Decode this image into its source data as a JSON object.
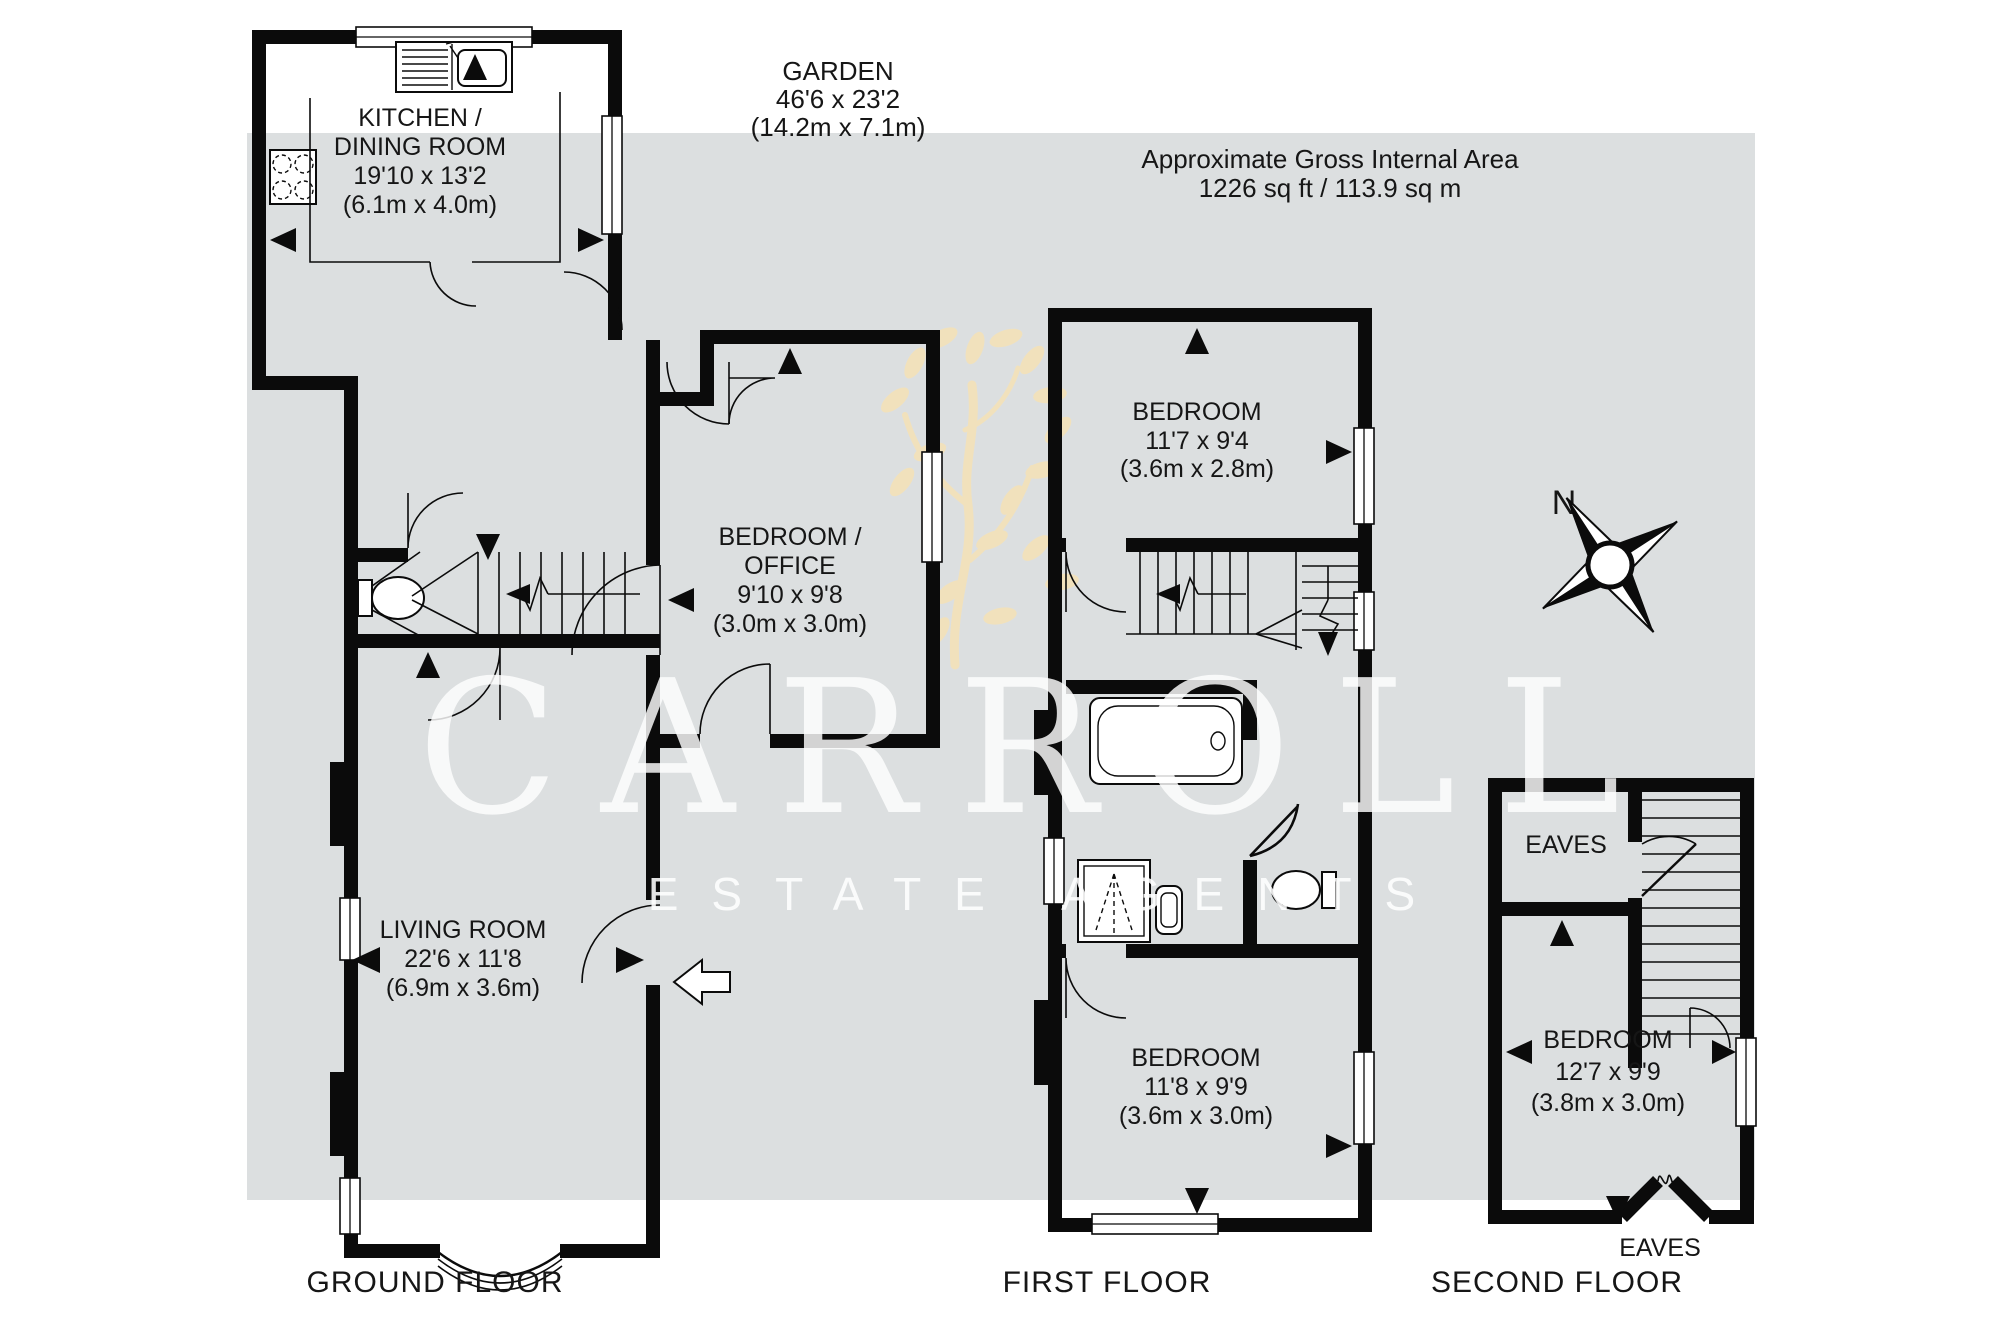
{
  "canvas": {
    "background": "#ffffff",
    "panel_color": "#dcdfe0",
    "ink_color": "#0b0b0b",
    "leaf_color": "#f3e2bb",
    "watermark_color": "#ffffff"
  },
  "garden": {
    "name": "GARDEN",
    "size_imperial": "46'6 x 23'2",
    "size_metric": "(14.2m x 7.1m)"
  },
  "area_note": {
    "line1": "Approximate Gross Internal Area",
    "line2": "1226 sq ft / 113.9 sq m"
  },
  "compass": {
    "north": "N"
  },
  "watermark": {
    "brand": "CARROLL",
    "tagline": "ESTATE AGENTS"
  },
  "ground_floor": {
    "label": "GROUND FLOOR",
    "kitchen": {
      "line1": "KITCHEN /",
      "line2": "DINING ROOM",
      "size_imperial": "19'10 x 13'2",
      "size_metric": "(6.1m x 4.0m)"
    },
    "bedroom_office": {
      "line1": "BEDROOM /",
      "line2": "OFFICE",
      "size_imperial": "9'10 x 9'8",
      "size_metric": "(3.0m x 3.0m)"
    },
    "living_room": {
      "line1": "LIVING ROOM",
      "size_imperial": "22'6 x 11'8",
      "size_metric": "(6.9m x 3.6m)"
    }
  },
  "first_floor": {
    "label": "FIRST FLOOR",
    "bedroom_top": {
      "line1": "BEDROOM",
      "size_imperial": "11'7 x 9'4",
      "size_metric": "(3.6m x 2.8m)"
    },
    "bedroom_bottom": {
      "line1": "BEDROOM",
      "size_imperial": "11'8 x 9'9",
      "size_metric": "(3.6m x 3.0m)"
    }
  },
  "second_floor": {
    "label": "SECOND FLOOR",
    "eaves_top": "EAVES",
    "bedroom": {
      "line1": "BEDROOM",
      "size_imperial": "12'7 x 9'9",
      "size_metric": "(3.8m x 3.0m)"
    },
    "eaves_bottom": "EAVES"
  }
}
